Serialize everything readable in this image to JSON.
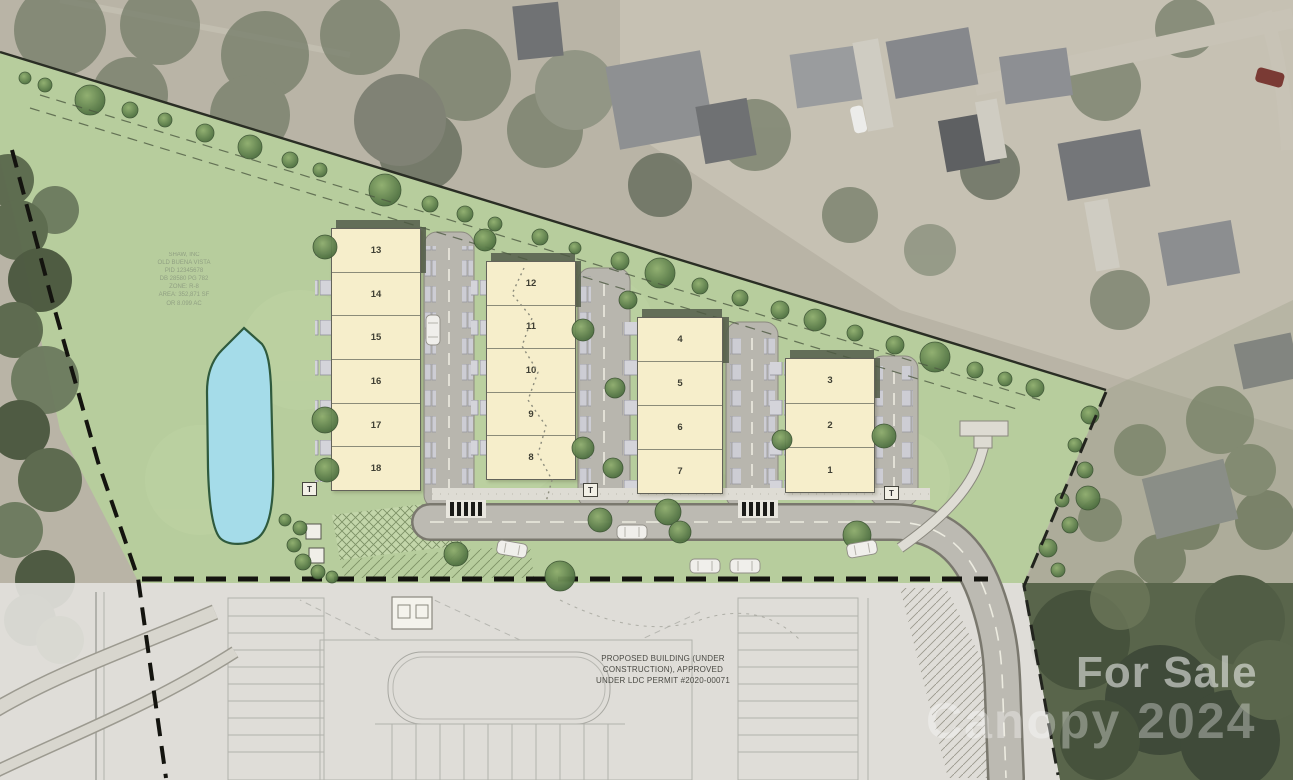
{
  "watermarks": {
    "for_sale": "For Sale",
    "brand_year": "Canopy 2024"
  },
  "site": {
    "buildings": [
      {
        "name": "building-units-13-18",
        "units": [
          "13",
          "14",
          "15",
          "16",
          "17",
          "18"
        ]
      },
      {
        "name": "building-units-8-12",
        "units": [
          "12",
          "11",
          "10",
          "9",
          "8"
        ]
      },
      {
        "name": "building-units-4-7",
        "units": [
          "4",
          "5",
          "6",
          "7"
        ]
      },
      {
        "name": "building-units-1-3",
        "units": [
          "3",
          "2",
          "1"
        ]
      }
    ],
    "transformer_label": "T",
    "construction_note": [
      "PROPOSED BUILDING (UNDER",
      "CONSTRUCTION), APPROVED",
      "UNDER LDC PERMIT #2020-00071"
    ],
    "parcel_note_lines": [
      "SHAW, INC",
      "OLD BUENA VISTA",
      "PID 12345678",
      "DB 28580 PG 782",
      "ZONE: R-8",
      "AREA: 352,871 SF",
      "OR 8.099 AC"
    ]
  },
  "colors": {
    "site_green": "#b7cd9d",
    "building_fill": "#f6eecb",
    "pond_fill": "#a5dce9",
    "road_gray": "#bcbab2",
    "forest_dark": "#59654b"
  }
}
